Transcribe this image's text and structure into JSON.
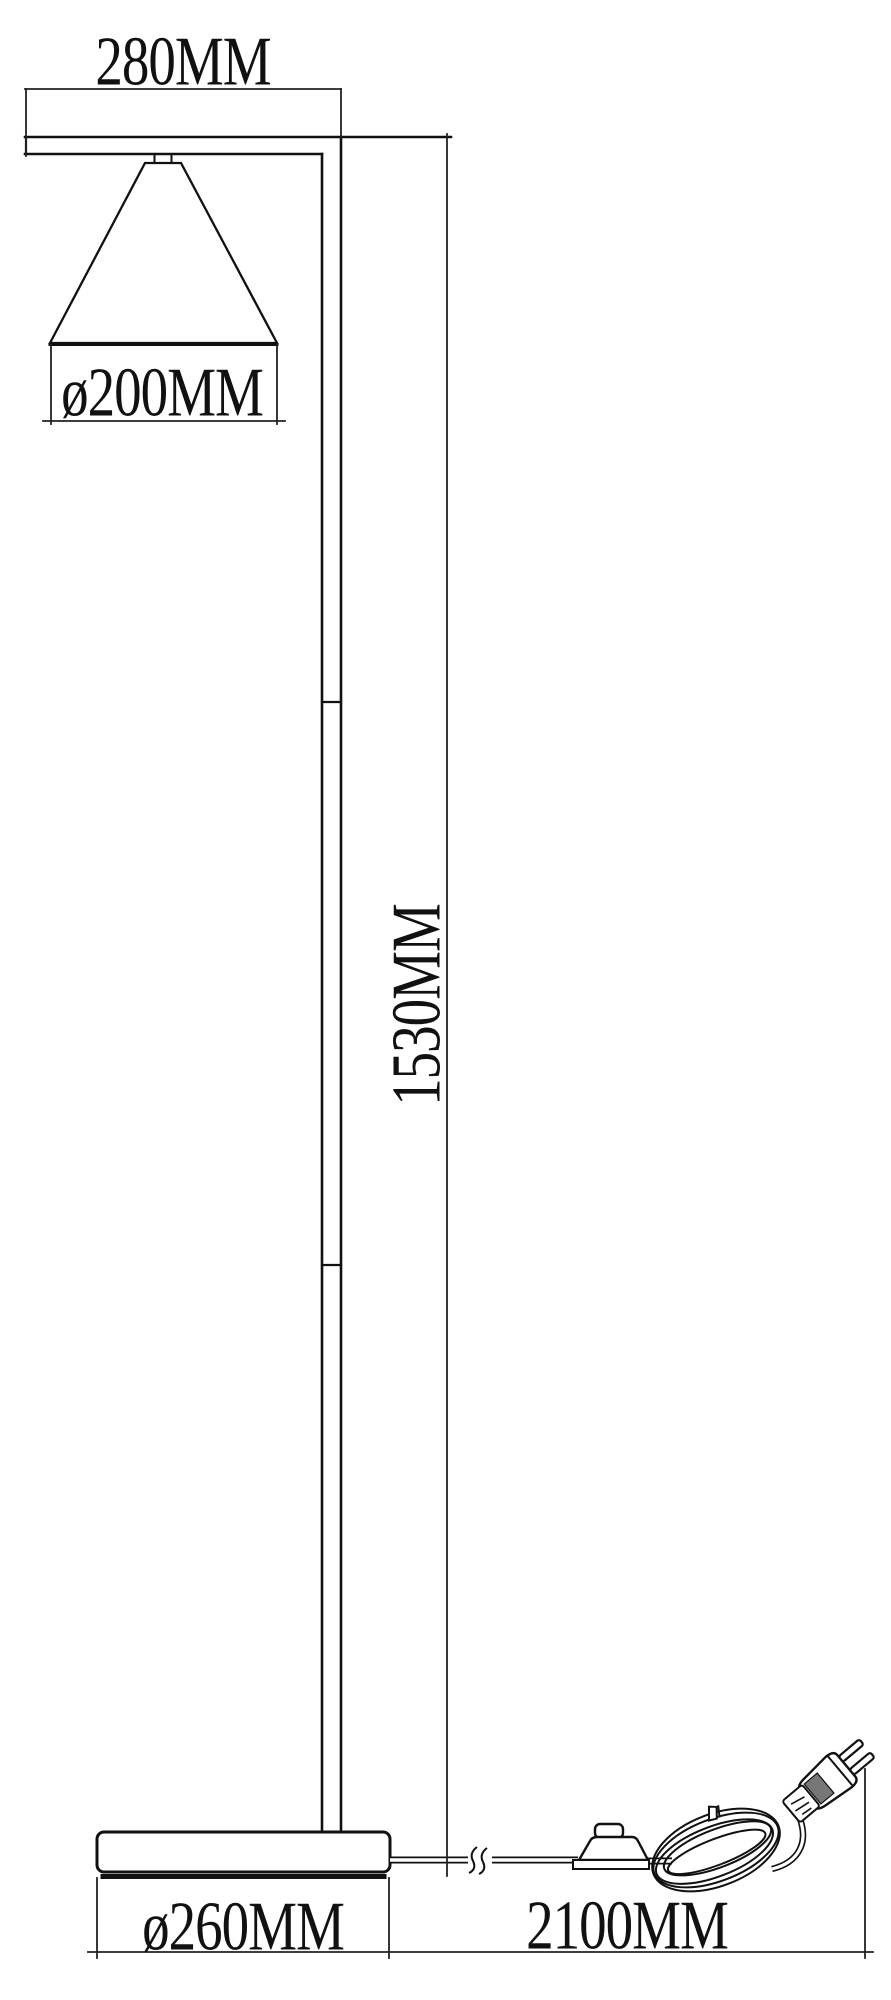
{
  "page": {
    "background": "#ffffff",
    "line_color": "#1a1a1a"
  },
  "drawing": {
    "subject": "floor lamp technical dimension drawing",
    "unit": "MM",
    "labels": {
      "arm_width": "280MM",
      "shade_diameter": "ø200MM",
      "lamp_height": "1530MM",
      "base_diameter": "ø260MM",
      "cord_length": "2100MM"
    },
    "dimensions_mm": {
      "arm_width": 280,
      "shade_diameter": 200,
      "lamp_height": 1530,
      "base_diameter": 260,
      "cord_length": 2100
    }
  }
}
